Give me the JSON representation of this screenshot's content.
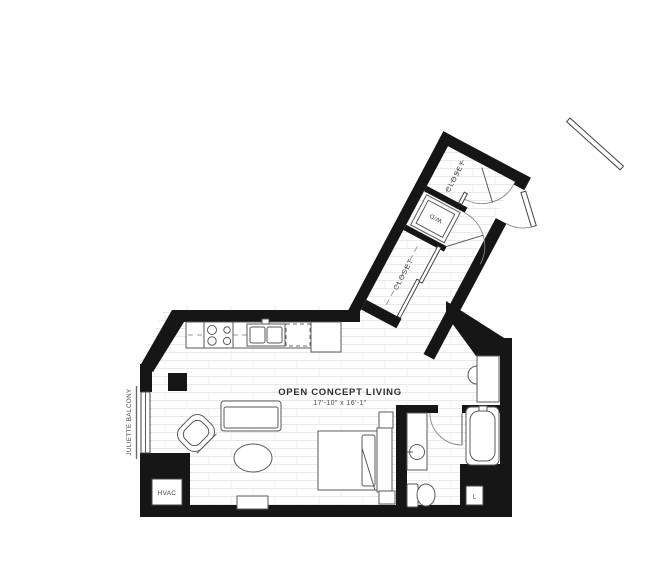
{
  "plan": {
    "labels": {
      "living_room": "OPEN CONCEPT LIVING",
      "living_room_dims": "17'-10\" x 16'-1\"",
      "closet_lower": "CLOSET",
      "closet_upper": "CLOSET",
      "washer_dryer": "W/D",
      "hvac": "HVAC",
      "juliette_balcony": "JULIETTE BALCONY",
      "linen_closet": "L"
    },
    "colors": {
      "walls": "#161616",
      "fixture_stroke": "#5a5a5a",
      "label_text": "#3f3f3f",
      "floor_lines": "#e9e9e9",
      "background": "#ffffff"
    },
    "fixtures": [
      "range-cooktop",
      "kitchen-sink",
      "dishwasher",
      "refrigerator",
      "sofa",
      "armchair",
      "coffee-table",
      "media-console",
      "bed",
      "nightstand",
      "headboard",
      "bathroom-vanity-sink",
      "toilet",
      "bathtub",
      "entry-vanity-sink",
      "washer-dryer-unit",
      "closet-rod",
      "door-swing",
      "juliette-balcony-window",
      "hvac-unit",
      "linen-closet",
      "structural-column"
    ]
  }
}
